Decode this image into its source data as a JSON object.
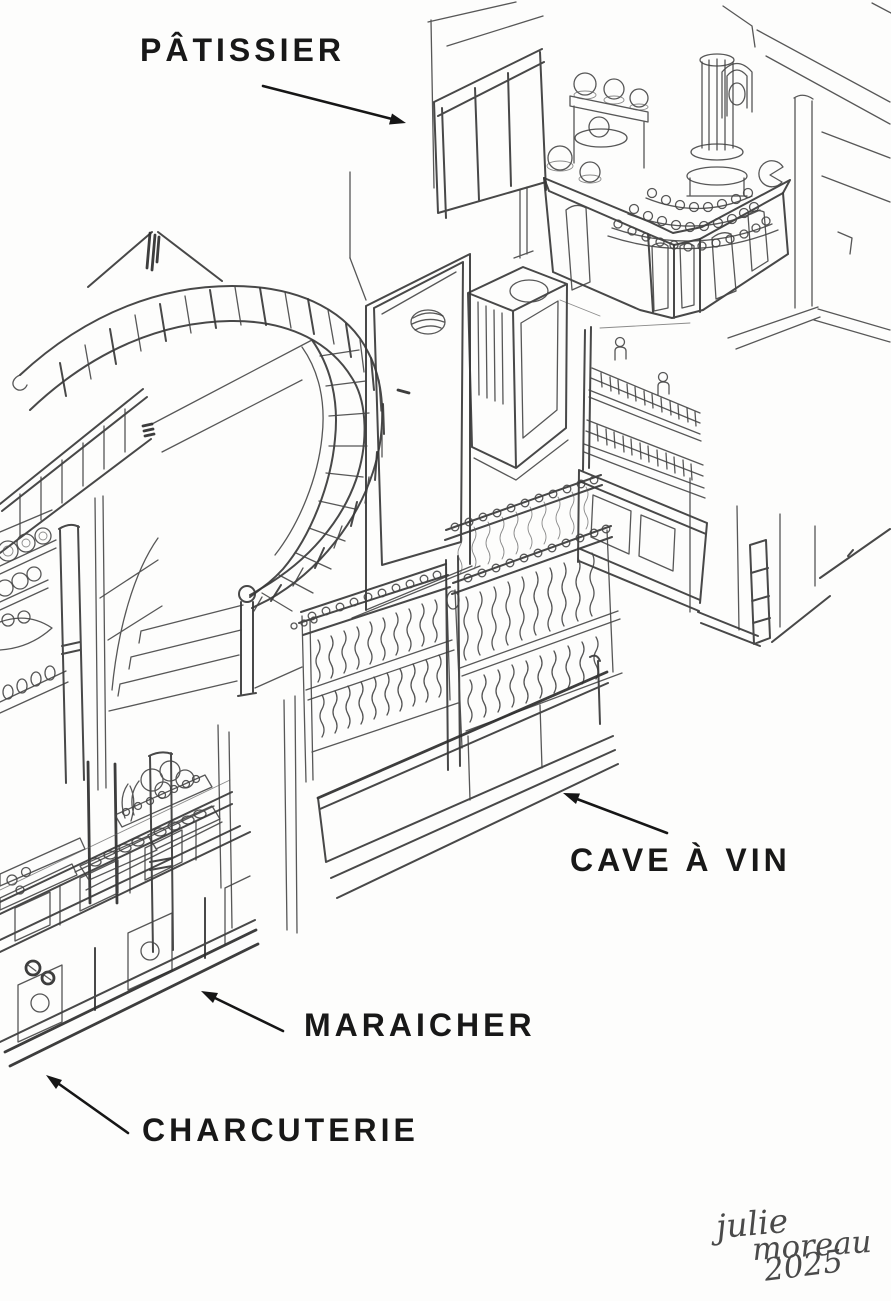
{
  "canvas": {
    "width": 891,
    "height": 1301,
    "background": "#fdfdfc",
    "pencil_color": "#3f3f3f",
    "label_color": "#181818"
  },
  "labels": {
    "patissier": "PÂTISSIER",
    "cave_a_vin": "CAVE À VIN",
    "maraicher": "MARAICHER",
    "charcuterie": "CHARCUTERIE"
  },
  "signature": {
    "line1": "julie",
    "line2": "moreau",
    "line3": "2025"
  }
}
